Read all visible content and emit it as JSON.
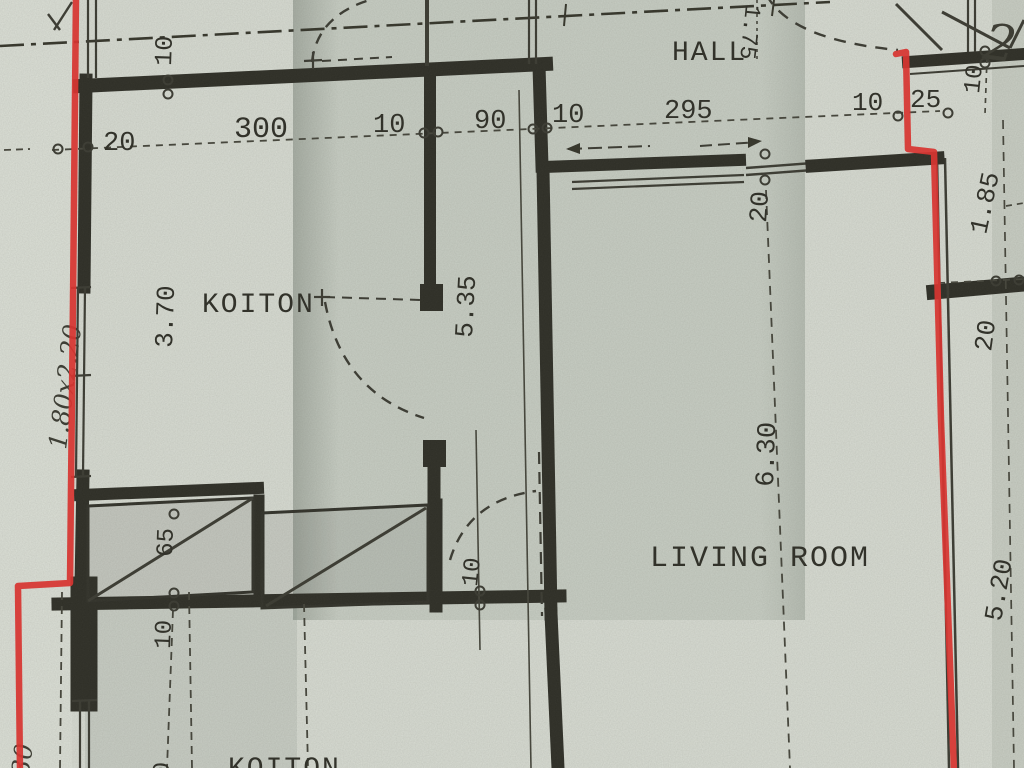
{
  "colors": {
    "paper": "#d8dcd3",
    "ink": "#2f2f28",
    "red_marker": "#e2322e"
  },
  "rooms": {
    "hall": "HALL",
    "koiton": "KOITON",
    "living_room": "LIVING ROOM",
    "koiton_lower": "KOITON"
  },
  "dims": {
    "d20": "20",
    "d300": "300",
    "d10": "10",
    "d90": "90",
    "d295": "295",
    "d25": "25",
    "d65": "65",
    "d175": "1.75",
    "d185": "1.85",
    "d370": "3.70",
    "d535": "5.35",
    "d630": "6.30",
    "d520": "5.20"
  },
  "handwritten": {
    "window_note": "1.80x2.20",
    "width_note": "2.30",
    "mark": "2"
  }
}
